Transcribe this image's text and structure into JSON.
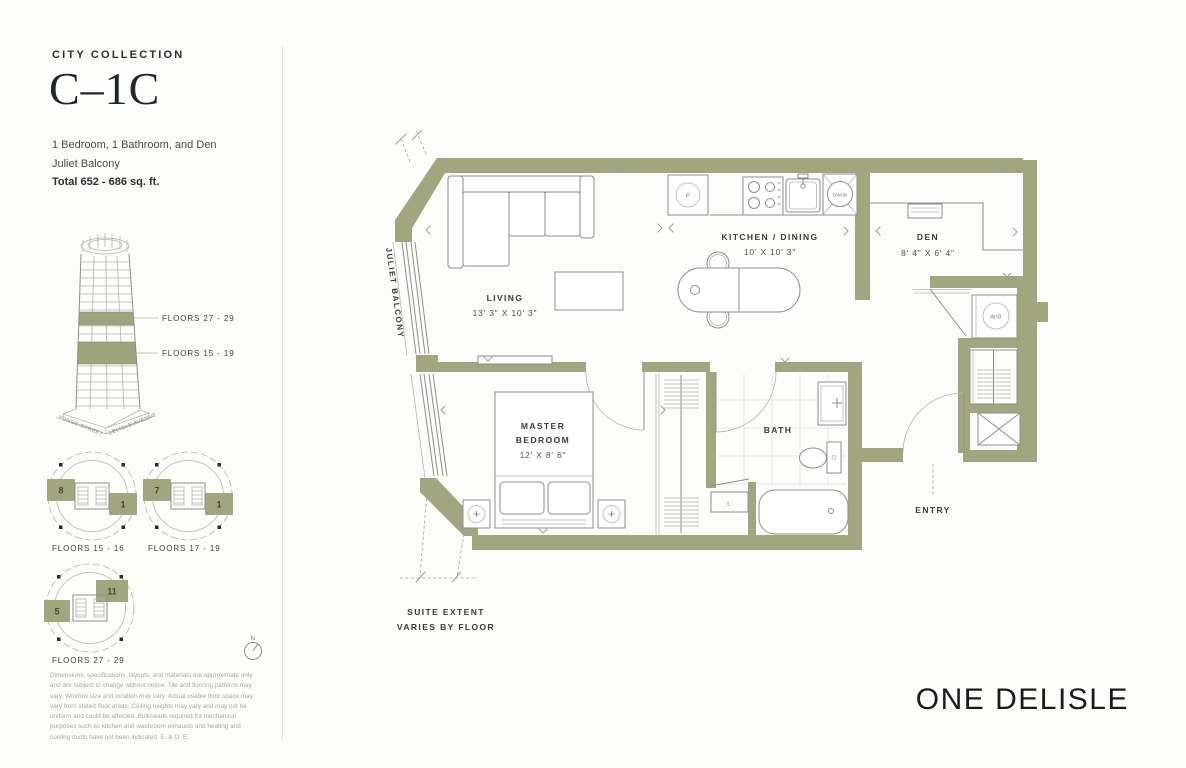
{
  "header": {
    "collection": "CITY COLLECTION",
    "unit": "C–1C",
    "bed_bath": "1 Bedroom, 1 Bathroom, and Den",
    "balcony": "Juliet Balcony",
    "total": "Total  652 - 686 sq. ft."
  },
  "building": {
    "band_upper": "FLOORS 27 - 29",
    "band_lower": "FLOORS 15 - 19",
    "street_left": "YONGE STREET",
    "street_right": "DELISLE AVENUE"
  },
  "floorplates": [
    {
      "caption": "FLOORS 15 - 16",
      "left_unit": "8",
      "right_unit": "1"
    },
    {
      "caption": "FLOORS 17 - 19",
      "left_unit": "7",
      "right_unit": "1"
    },
    {
      "caption": "FLOORS 27 - 29",
      "left_unit": "5",
      "right_unit": "11"
    }
  ],
  "compass": {
    "label": "N"
  },
  "disclaimer": "Dimensions, specifications, layouts, and materials are approximate only and are subject to change without notice. Tile and flooring patterns may vary. Window size and location may vary. Actual usable floor space may vary from stated floor areas. Ceiling heights may vary and may not be uniform and could be affected. Bulkheads required for mechanical purposes such as kitchen and washroom exhausts and heating and cooling ducts have not been indicated. E. & O. E.",
  "brand": "ONE DELISLE",
  "plan": {
    "balcony_label": "JULIET BALCONY",
    "suite_extent_1": "SUITE EXTENT",
    "suite_extent_2": "VARIES BY FLOOR",
    "rooms": {
      "living": {
        "name": "LIVING",
        "dims": "13' 3\" X 10' 3\""
      },
      "kitchen": {
        "name": "KITCHEN / DINING",
        "dims": "10' X 10' 3\""
      },
      "den": {
        "name": "DEN",
        "dims": "8' 4\" X 6' 4\""
      },
      "master": {
        "name_1": "MASTER",
        "name_2": "BEDROOM",
        "dims": "12' X 8' 6\""
      },
      "bath": {
        "name": "BATH"
      },
      "entry": {
        "name": "ENTRY"
      }
    },
    "fixtures": {
      "fridge": "F",
      "dishwasher": "DW/M",
      "washer_dryer": "W/D",
      "linen": "L"
    },
    "colors": {
      "wall": "#a2a67f",
      "line": "#8e8e8e",
      "text": "#3a3a3a"
    }
  }
}
